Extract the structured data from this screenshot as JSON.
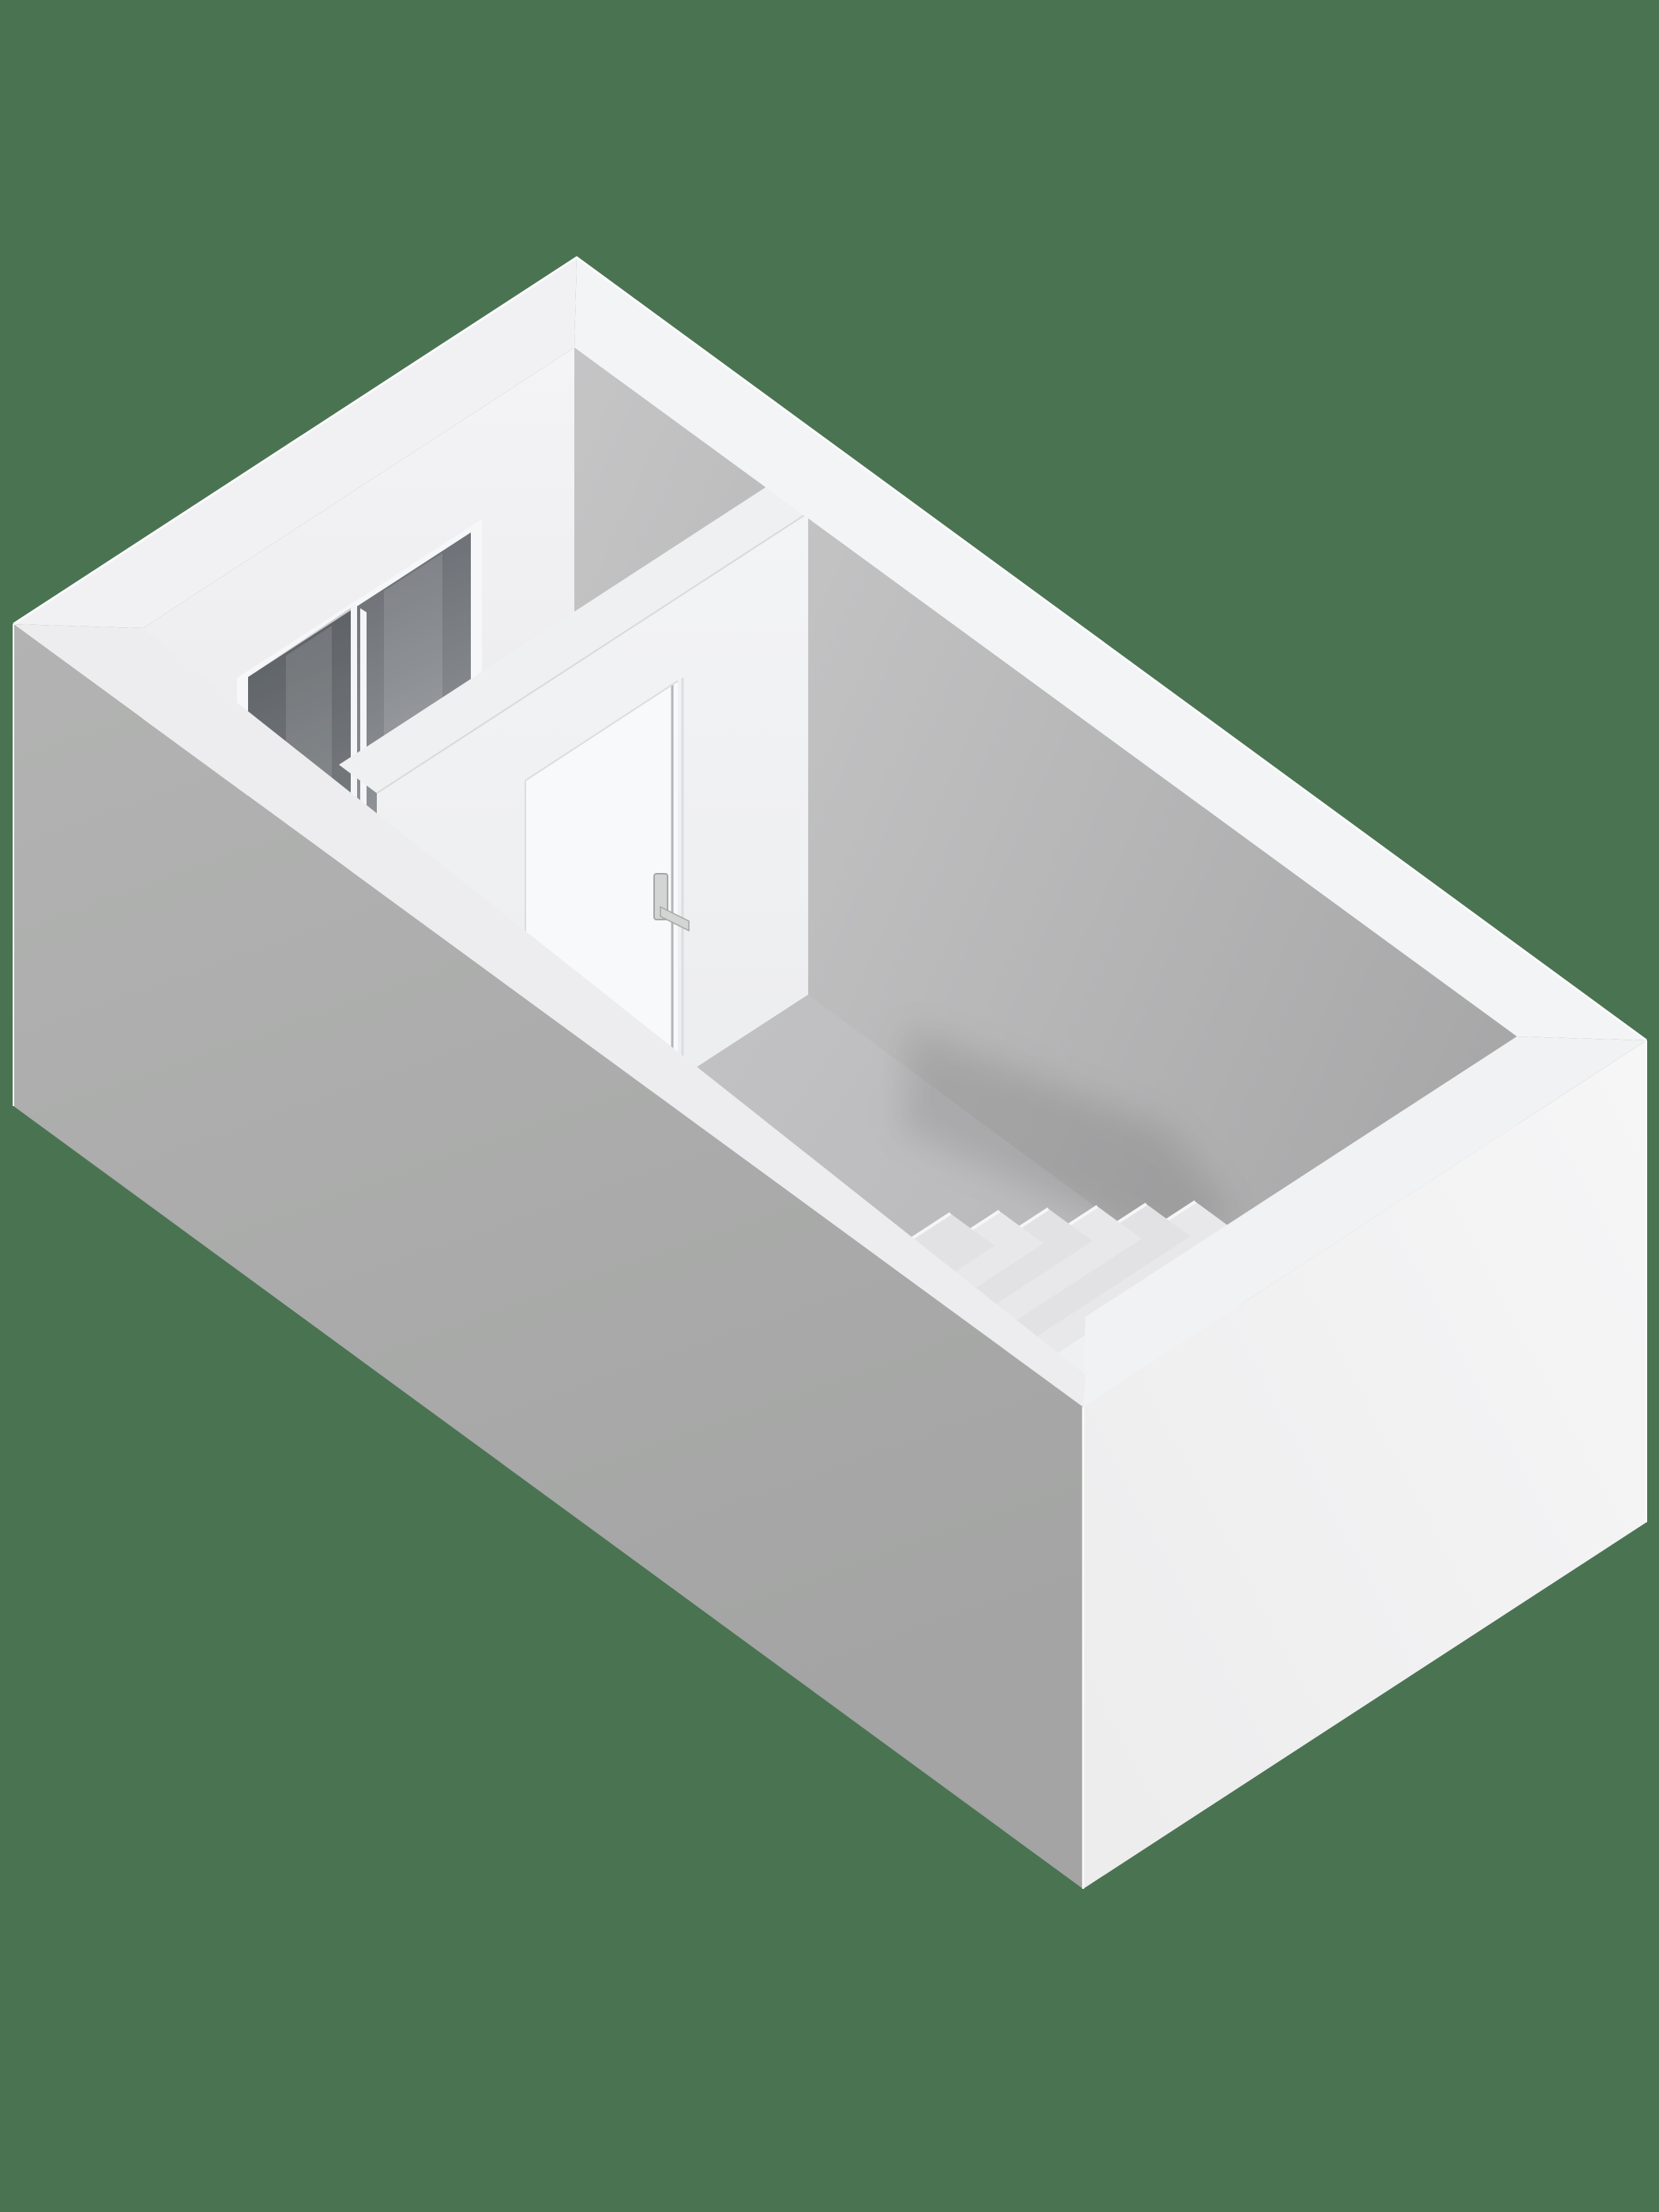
{
  "scene": {
    "type": "3d-floorplan-render",
    "rooms": 2,
    "window_panes": 2,
    "doors": 1,
    "stair_steps": 6,
    "background": "#4a7352"
  },
  "colors": {
    "bg": "#4a7352",
    "int_right_top": "#cccccd",
    "int_right_bottom": "#a8a8a9",
    "int_left_top": "#f4f4f6",
    "int_left_bottom": "#e6e6e8",
    "floor_small_top": "#e1e1e3",
    "floor_small_bottom": "#cbcbcd",
    "floor_big_near": "#c7c7c9",
    "floor_big_far": "#b1b1b3",
    "ext_sw_top": "#b2b3b2",
    "ext_sw_bottom": "#a3a4a3",
    "ext_se_top": "#f6f6f7",
    "ext_se_bottom": "#ededee",
    "band_far_left": "#f1f1f3",
    "band_far_right": "#f3f4f5",
    "band_near_left": "#ededef",
    "band_near_right": "#f1f2f3",
    "band_partition": "#eef0f1",
    "partition_face_top": "#f3f4f5",
    "partition_face_bottom": "#eaebed",
    "door_panel": "#f8f9fa",
    "door_seam_dark": "#b4b5b7",
    "door_seam_light": "#dcdde0",
    "handle": "#d3d5d4",
    "handle_edge": "#a6a8a7",
    "window_frame": "#f6f7f8",
    "glass_top": "#60646a",
    "glass_bottom": "#9da1a5",
    "glass_shade": "rgba(18,20,24,0.18)",
    "sheen": "rgba(255,255,255,0.12)",
    "mullion": "#f4f5f6",
    "tread_a": "#e8e8ea",
    "tread_b": "#e2e2e4",
    "riser_highlight": "#f6f6f8",
    "well_face": "#eff0f1",
    "face_shade": "rgba(0,0,0,0.03)",
    "shadow_soft": "rgba(0,0,0,0.10)",
    "edge_highlight": "#fbfbfc"
  }
}
